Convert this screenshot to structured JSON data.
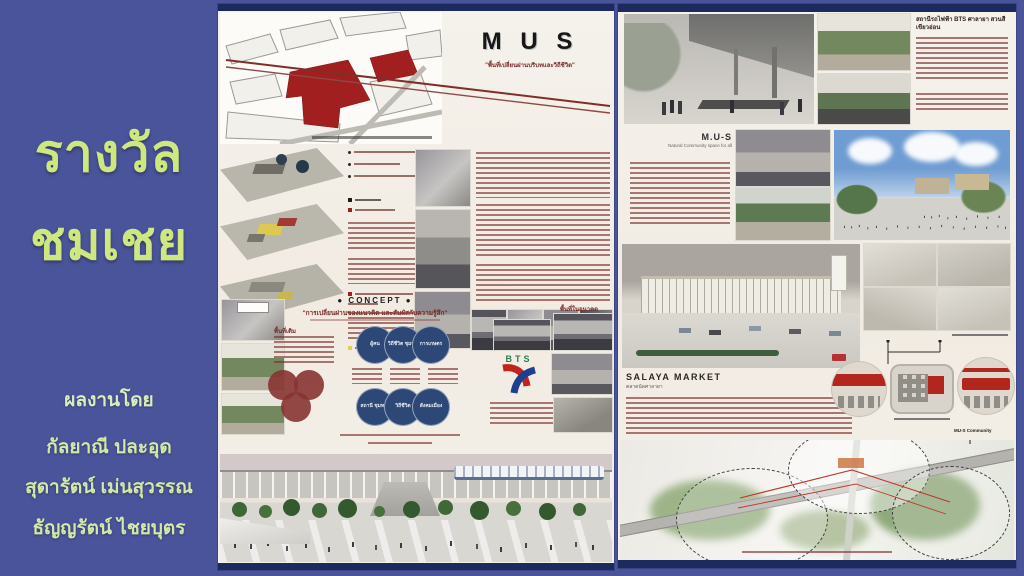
{
  "colors": {
    "background": "#4a549b",
    "accent_green": "#cde87e",
    "poster_paper": "#f3efe7",
    "navy_bar": "#1d2a5e",
    "maroon_text": "#7a2b28",
    "venn_blue": "#2d4877",
    "venn_red": "#8c3a38",
    "highlight_red": "#a11f1f"
  },
  "sidebar": {
    "award_line1": "รางวัล",
    "award_line2": "ชมเชย",
    "credit_label": "ผลงานโดย",
    "authors": [
      "กัลยาณี ปละอุด",
      "สุดารัตน์ เม่นสุวรรณ",
      "ธัญญรัตน์ ไชยบุตร"
    ]
  },
  "left_poster": {
    "title": "M U S",
    "subtitle": "\"พื้นที่เปลี่ยนผ่านบริบทและวิถีชีวิต\"",
    "concept": {
      "heading": "● CONCEPT ●",
      "quote": "\"การเปลี่ยนผ่านของแนวคิด และสัมผัสกับความรู้สึก\"",
      "venn_row1": [
        "ผู้คน",
        "วิถีชีวิต ชุมชน",
        "การเกษตร"
      ],
      "venn_row2": [
        "สถานี ชุมทาง",
        "วิถีชีวิต",
        "สังคมเมือง"
      ]
    },
    "labels": {
      "area_old": "พื้นที่เดิม",
      "area_future": "พื้นที่ในอนาคต",
      "bts": "BTS"
    }
  },
  "right_poster": {
    "station_heading": "สถานีรถไฟฟ้า BTS ศาลายา สวนสีเขียวอ่อน",
    "mus": {
      "heading": "M.U-S",
      "subheading": "Natural Community space for all"
    },
    "market": {
      "heading": "SALAYA MARKET",
      "subheading": "ตลาดนัดศาลายา"
    },
    "community_label": "MU-S Community"
  }
}
